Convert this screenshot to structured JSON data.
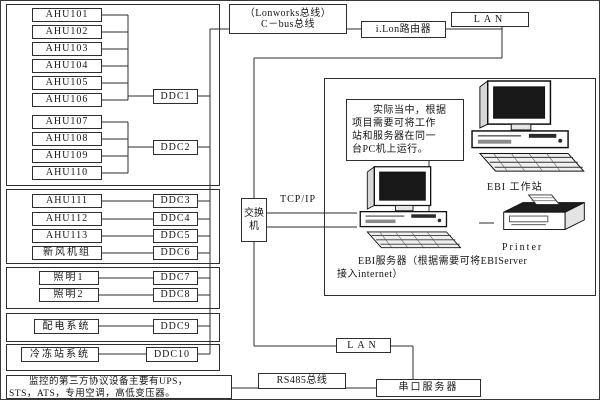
{
  "field_bus": {
    "group1": {
      "devices": [
        "AHU101",
        "AHU102",
        "AHU103",
        "AHU104",
        "AHU105",
        "AHU106",
        "AHU107",
        "AHU108",
        "AHU109",
        "AHU110"
      ],
      "controllers": [
        "DDC1",
        "DDC2"
      ]
    },
    "group2": {
      "devices": [
        "AHU111",
        "AHU112",
        "AHU113",
        "新风机组"
      ],
      "controllers": [
        "DDC3",
        "DDC4",
        "DDC5",
        "DDC6"
      ]
    },
    "group3": {
      "devices": [
        "照明1",
        "照明2"
      ],
      "controllers": [
        "DDC7",
        "DDC8"
      ]
    },
    "group4": {
      "devices": [
        "配电系统"
      ],
      "controllers": [
        "DDC9"
      ]
    },
    "group5": {
      "devices": [
        "冷冻站系统"
      ],
      "controllers": [
        "DDC10"
      ]
    },
    "third_party_note": "　　监控的第三方协议设备主要有UPS，\nSTS，ATS，专用空调，高低变压器。"
  },
  "backbone": {
    "cbus_label": "（Lonworks总线）\nC－bus总线",
    "ilon_router": "i.Lon路由器",
    "lan_top": "LAN",
    "tcpip_label": "TCP/IP",
    "switch_label": "交换机",
    "lan_bottom": "LAN",
    "rs485_label": "RS485总线",
    "serial_server": "串口服务器"
  },
  "ebi_system": {
    "note": "　　实际当中，根据\n项目需要可将工作\n站和服务器在同一\n台PC机上运行。",
    "workstation_label": "EBI 工作站",
    "printer_label": "Printer",
    "server_caption": "　　EBI服务器（根据需要可将EBIServer\n接入internet）"
  },
  "colors": {
    "line": "#2e2e2e",
    "screen": "#181818",
    "background": "#ffffff"
  }
}
